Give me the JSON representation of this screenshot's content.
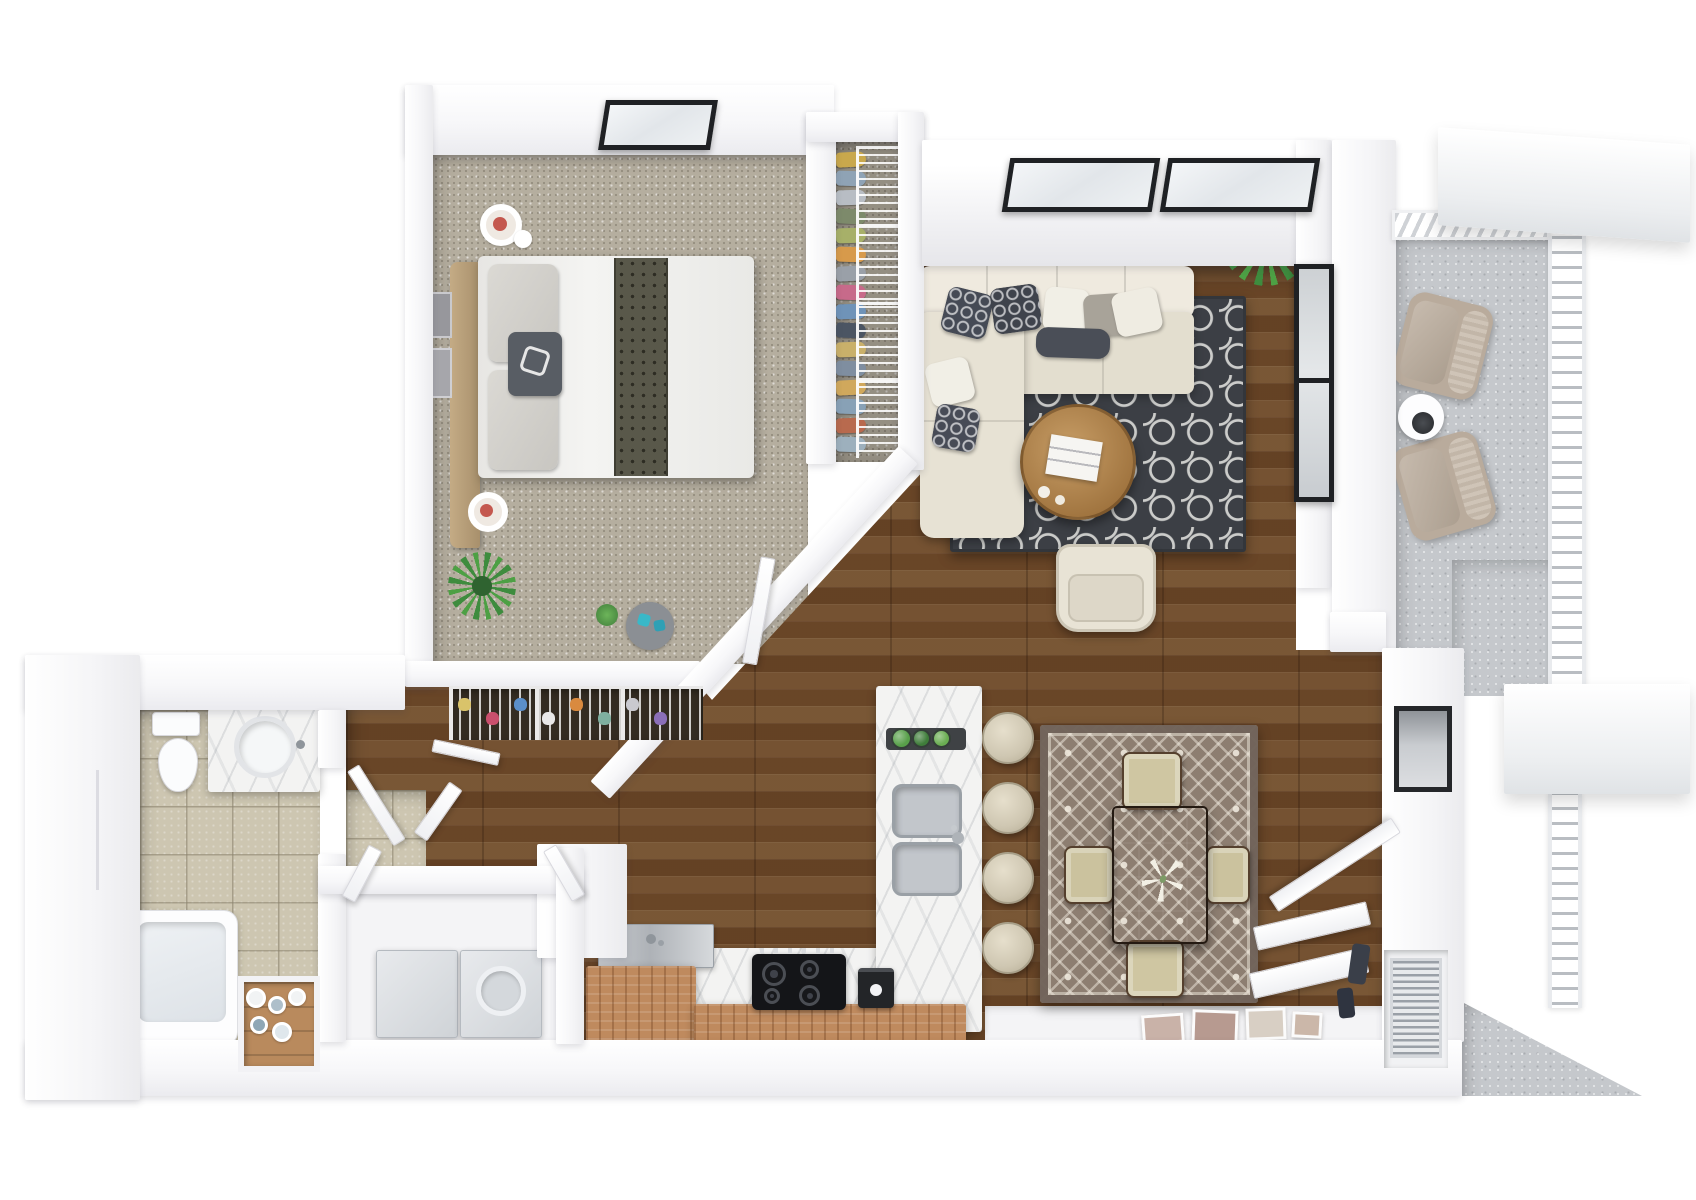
{
  "meta": {
    "title": "3D apartment floor plan rendering",
    "view": "top-down",
    "units": "px"
  },
  "palette": {
    "background": "#ffffff",
    "wall": "#f6f6f8",
    "carpet": "#b5ae9f",
    "hardwood": "#6e4a2b",
    "tile": "#cdc6b1",
    "concrete": "#c5c8cc",
    "marble": "#f3f3f2",
    "cabinet_wood": "#bf8a5e",
    "living_rug": "#3c3f45",
    "dining_rug": "#8d7e71",
    "sofa_cream": "#e9e4d6",
    "accent_dark": "#42465",
    "table_wood": "#3a2c20",
    "plant_green": "#4da044"
  },
  "rooms": {
    "bedroom": {
      "label": "Bedroom",
      "floor": "carpet"
    },
    "closet": {
      "label": "Walk-in closet",
      "floor": "carpet"
    },
    "living": {
      "label": "Living room",
      "floor": "hardwood"
    },
    "dining": {
      "label": "Dining area",
      "floor": "hardwood"
    },
    "kitchen": {
      "label": "Kitchen",
      "floor": "hardwood"
    },
    "bath": {
      "label": "Bathroom",
      "floor": "tile"
    },
    "laundry": {
      "label": "Laundry closet",
      "floor": "white"
    },
    "hall": {
      "label": "Hallway",
      "floor": "hardwood"
    },
    "balcony": {
      "label": "Balcony",
      "floor": "concrete"
    },
    "entry": {
      "label": "Entry",
      "floor": "white"
    }
  },
  "furniture": {
    "bed": "Queen bed with runner",
    "headboard": "Upholstered headboard",
    "nightstand_a": "Nightstand with candle tray",
    "nightstand_b": "Nightstand with candle tray",
    "desk": "Wood console desk",
    "bedroom_plant": "Potted agave",
    "wardrobe": "Closet rack with clothes",
    "shoe_rack": "Wire shoe baskets",
    "sofa": "L-shaped sectional sofa",
    "coffee_table": "Round wood coffee table",
    "armchair": "Wingback armchair",
    "living_plant": "Potted palm",
    "dining_table": "Dark wood dining table",
    "island": "Marble kitchen island with double sink",
    "cooktop": "4-burner cooktop",
    "coffee_maker": "Coffee machine",
    "washer": "Washer",
    "dryer": "Dryer",
    "toilet": "Toilet",
    "vanity": "Vanity with round sink",
    "bathtub": "Bathtub",
    "linen": "Linen shelf with towels",
    "balcony_chair_a": "Outdoor lounge chair",
    "balcony_chair_b": "Outdoor lounge chair",
    "balcony_table": "Round side table",
    "fireplace": "Wall fireplace",
    "water_heater": "Louvered utility closet",
    "entry_frames": "Leaning picture frames"
  },
  "decor": {
    "closet_clothes": [
      {
        "x": 836,
        "y": 152,
        "w": 30,
        "h": 15,
        "c": "#c9a84c",
        "rot": -3
      },
      {
        "x": 836,
        "y": 171,
        "w": 30,
        "h": 15,
        "c": "#8fa3b5",
        "rot": 2
      },
      {
        "x": 836,
        "y": 190,
        "w": 30,
        "h": 15,
        "c": "#b8bdc4",
        "rot": -2
      },
      {
        "x": 836,
        "y": 209,
        "w": 30,
        "h": 15,
        "c": "#7d8a6b",
        "rot": 3
      },
      {
        "x": 836,
        "y": 228,
        "w": 30,
        "h": 15,
        "c": "#a7b069",
        "rot": -2
      },
      {
        "x": 836,
        "y": 247,
        "w": 30,
        "h": 15,
        "c": "#d79a4b",
        "rot": 2
      },
      {
        "x": 836,
        "y": 266,
        "w": 30,
        "h": 15,
        "c": "#9aa0a8",
        "rot": -3
      },
      {
        "x": 836,
        "y": 285,
        "w": 30,
        "h": 15,
        "c": "#c76a8a",
        "rot": 2
      },
      {
        "x": 836,
        "y": 304,
        "w": 30,
        "h": 15,
        "c": "#6f93b8",
        "rot": -2
      },
      {
        "x": 836,
        "y": 323,
        "w": 30,
        "h": 15,
        "c": "#4b5563",
        "rot": 3
      },
      {
        "x": 836,
        "y": 342,
        "w": 30,
        "h": 15,
        "c": "#c9b06a",
        "rot": -2
      },
      {
        "x": 836,
        "y": 361,
        "w": 30,
        "h": 15,
        "c": "#7f8ea0",
        "rot": 2
      },
      {
        "x": 836,
        "y": 380,
        "w": 30,
        "h": 15,
        "c": "#d0a85c",
        "rot": -3
      },
      {
        "x": 836,
        "y": 399,
        "w": 30,
        "h": 15,
        "c": "#88a1b6",
        "rot": 2
      },
      {
        "x": 836,
        "y": 418,
        "w": 30,
        "h": 15,
        "c": "#b86a4e",
        "rot": -2
      },
      {
        "x": 836,
        "y": 437,
        "w": 30,
        "h": 15,
        "c": "#9db0bd",
        "rot": 2
      }
    ],
    "sofa_pillows": [
      {
        "x": 944,
        "y": 290,
        "w": 46,
        "h": 46,
        "c": "#454a55",
        "rot": 14,
        "cls": "pat"
      },
      {
        "x": 992,
        "y": 286,
        "w": 48,
        "h": 46,
        "c": "#3f434c",
        "rot": -8,
        "cls": "pat"
      },
      {
        "x": 1044,
        "y": 288,
        "w": 44,
        "h": 44,
        "c": "#f1efe6",
        "rot": 6
      },
      {
        "x": 1084,
        "y": 294,
        "w": 42,
        "h": 42,
        "c": "#a8a399",
        "rot": -4
      },
      {
        "x": 1114,
        "y": 290,
        "w": 46,
        "h": 44,
        "c": "#efece2",
        "rot": -12
      },
      {
        "x": 1036,
        "y": 328,
        "w": 74,
        "h": 30,
        "c": "#4a4e57",
        "rot": 2,
        "cls": "lumbar"
      },
      {
        "x": 928,
        "y": 360,
        "w": 44,
        "h": 44,
        "c": "#f1efe6",
        "rot": -14
      },
      {
        "x": 934,
        "y": 406,
        "w": 44,
        "h": 44,
        "c": "#474b56",
        "rot": 10,
        "cls": "pat"
      }
    ],
    "bar_stools": [
      {
        "x": 982,
        "y": 712,
        "w": 52,
        "h": 52
      },
      {
        "x": 982,
        "y": 782,
        "w": 52,
        "h": 52
      },
      {
        "x": 982,
        "y": 852,
        "w": 52,
        "h": 52
      },
      {
        "x": 982,
        "y": 922,
        "w": 52,
        "h": 52
      }
    ],
    "burners": [
      {
        "x": 762,
        "y": 962,
        "w": 24,
        "h": 24
      },
      {
        "x": 800,
        "y": 960,
        "w": 19,
        "h": 19
      },
      {
        "x": 764,
        "y": 988,
        "w": 16,
        "h": 16
      },
      {
        "x": 799,
        "y": 985,
        "w": 21,
        "h": 21
      }
    ],
    "herbs": [
      {
        "x": 893,
        "y": 730,
        "w": 17,
        "h": 17,
        "c": "#58a04a"
      },
      {
        "x": 914,
        "y": 731,
        "w": 15,
        "h": 15,
        "c": "#3f7d3a"
      },
      {
        "x": 934,
        "y": 731,
        "w": 15,
        "h": 15,
        "c": "#6aae52"
      }
    ],
    "towels": [
      {
        "x": 246,
        "y": 988,
        "w": 20,
        "h": 20,
        "c": "#f1f3f4"
      },
      {
        "x": 268,
        "y": 996,
        "w": 18,
        "h": 18,
        "c": "#aebfca"
      },
      {
        "x": 288,
        "y": 988,
        "w": 18,
        "h": 18,
        "c": "#f1f3f4"
      },
      {
        "x": 250,
        "y": 1016,
        "w": 18,
        "h": 18,
        "c": "#8fa7b5"
      },
      {
        "x": 272,
        "y": 1022,
        "w": 20,
        "h": 20,
        "c": "#dfe7ec"
      }
    ],
    "shoes": [
      {
        "x": 458,
        "y": 698,
        "w": 13,
        "h": 13,
        "c": "#d9c36a"
      },
      {
        "x": 486,
        "y": 712,
        "w": 13,
        "h": 13,
        "c": "#c94f6d"
      },
      {
        "x": 514,
        "y": 698,
        "w": 13,
        "h": 13,
        "c": "#5b8fc9"
      },
      {
        "x": 542,
        "y": 712,
        "w": 13,
        "h": 13,
        "c": "#e8e8e8"
      },
      {
        "x": 570,
        "y": 698,
        "w": 13,
        "h": 13,
        "c": "#d98a3f"
      },
      {
        "x": 598,
        "y": 712,
        "w": 13,
        "h": 13,
        "c": "#7fb0a0"
      },
      {
        "x": 626,
        "y": 698,
        "w": 13,
        "h": 13,
        "c": "#c9c9cf"
      },
      {
        "x": 654,
        "y": 712,
        "w": 13,
        "h": 13,
        "c": "#8a6fb8"
      }
    ],
    "frames": [
      {
        "x": 1142,
        "y": 1014,
        "w": 42,
        "h": 30,
        "c": "#c9b2a8",
        "rot": -4
      },
      {
        "x": 1192,
        "y": 1010,
        "w": 46,
        "h": 34,
        "c": "#b79a90",
        "rot": 2
      },
      {
        "x": 1246,
        "y": 1008,
        "w": 40,
        "h": 32,
        "c": "#d8cfc4",
        "rot": -2
      },
      {
        "x": 1292,
        "y": 1012,
        "w": 30,
        "h": 26,
        "c": "#cbb7a9",
        "rot": 3
      }
    ],
    "dining_chairs": [
      {
        "x": 1122,
        "y": 752,
        "w": 60,
        "h": 58,
        "c": "#cfc6a2"
      },
      {
        "x": 1126,
        "y": 940,
        "w": 58,
        "h": 58,
        "c": "#cfc6a2"
      },
      {
        "x": 1064,
        "y": 846,
        "w": 50,
        "h": 58,
        "c": "#cbc29e"
      },
      {
        "x": 1206,
        "y": 846,
        "w": 44,
        "h": 58,
        "c": "#cbc29e"
      }
    ],
    "entry_items": [
      {
        "x": 1350,
        "y": 944,
        "w": 18,
        "h": 40,
        "c": "#3a3f49",
        "rot": 8
      },
      {
        "x": 1338,
        "y": 988,
        "w": 16,
        "h": 30,
        "c": "#2f3440",
        "rot": -6
      }
    ]
  }
}
